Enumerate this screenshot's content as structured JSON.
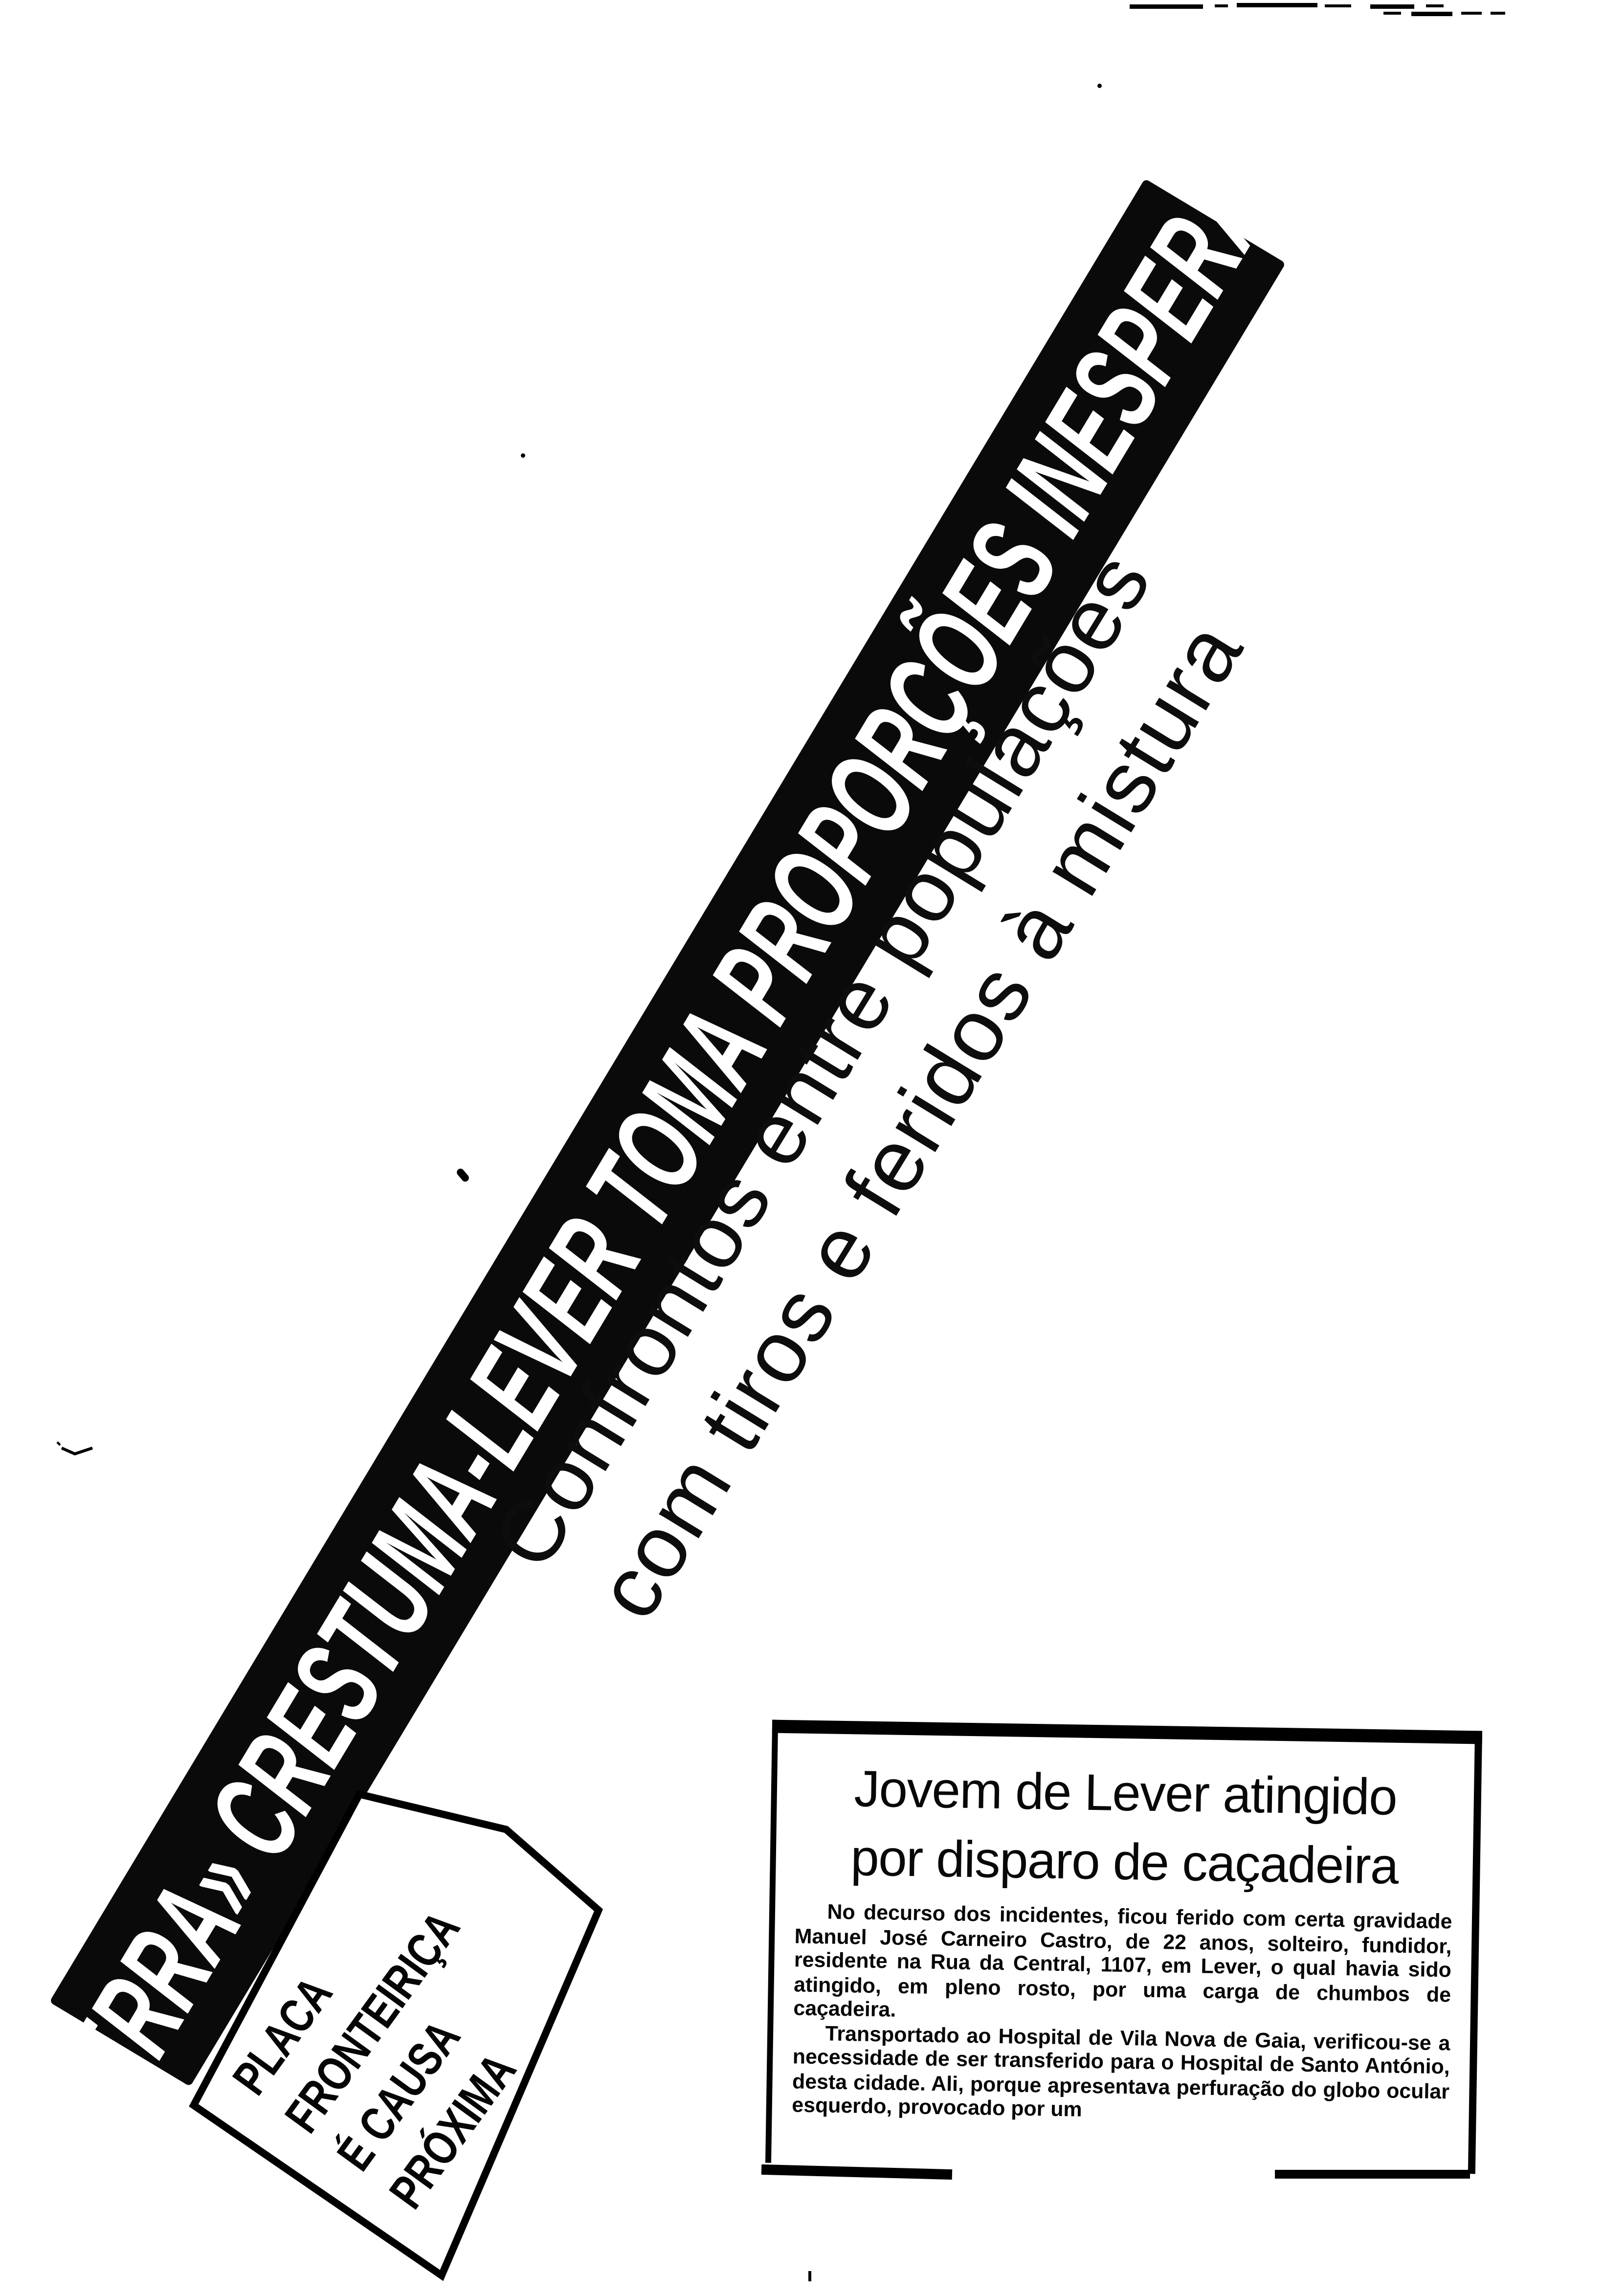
{
  "page": {
    "background": "#ffffff",
    "ink": "#000000",
    "banner_bg": "#0a0a0a",
    "banner_ink": "#ffffff"
  },
  "banner": {
    "text": "«GUERRA» CRESTUMA-LEVER TOMA PROPORÇÕES INESPERADAS"
  },
  "subtitle": {
    "line1": "Confrontos entre populações",
    "line2": "com tiros e feridos à mistura"
  },
  "side_box": {
    "lines": [
      "PLACA",
      "FRONTEIRIÇA",
      "É CAUSA",
      "PRÓXIMA"
    ]
  },
  "article": {
    "headline_line1": "Jovem de Lever atingido",
    "headline_line2": "por disparo de caçadeira",
    "paragraphs": [
      "No decurso dos incidentes, ficou ferido com certa gravidade Manuel José Carneiro Castro, de 22 anos, solteiro, fundidor, residente na Rua da Central, 1107, em Lever, o qual havia sido atingido, em pleno rosto, por uma carga de chumbos de caçadeira.",
      "Transportado ao Hospital de Vila Nova de Gaia, verificou-se a necessidade de ser transferido para o Hospital de Santo António, desta cidade. Ali, porque apresentava perfuração do globo ocular esquerdo, provocado por um"
    ]
  }
}
